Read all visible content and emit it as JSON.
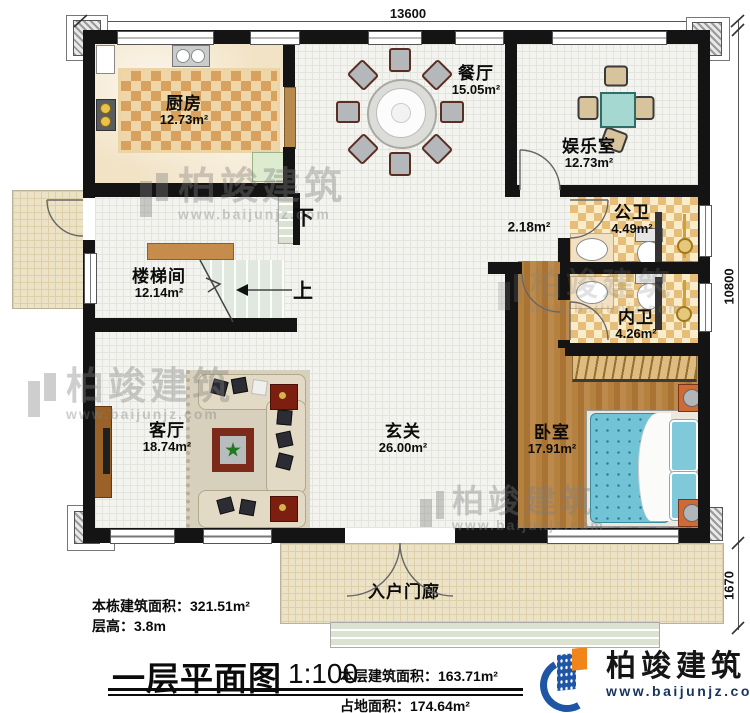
{
  "plan": {
    "dimensions": {
      "top": "13600",
      "right": "10800",
      "porch": "1670"
    },
    "rooms": [
      {
        "name": "厨房",
        "area": "12.73m²"
      },
      {
        "name": "餐厅",
        "area": "15.05m²"
      },
      {
        "name": "娱乐室",
        "area": "12.73m²"
      },
      {
        "name": "公卫",
        "area": "4.49m²"
      },
      {
        "name": "内卫",
        "area": "4.26m²"
      },
      {
        "name": "卧室",
        "area": "17.91m²"
      },
      {
        "name": "玄关",
        "area": "26.00m²"
      },
      {
        "name": "客厅",
        "area": "18.74m²"
      },
      {
        "name": "楼梯间",
        "area": "12.14m²"
      },
      {
        "name": "入户门廊",
        "area": ""
      }
    ],
    "annotations": {
      "passage_area": "2.18m²",
      "stairs_up": "上",
      "stairs_down": "下"
    }
  },
  "info": {
    "building_area_label": "本栋建筑面积：",
    "building_area_value": "321.51m²",
    "floor_height_label": "层高：",
    "floor_height_value": "3.8m"
  },
  "title_block": {
    "title": "一层平面图",
    "scale": "1:100",
    "floor_area_label": "本层建筑面积：",
    "floor_area_value": "163.71m²",
    "footprint_label": "占地面积：",
    "footprint_value": "174.64m²"
  },
  "brand": {
    "name": "柏竣建筑",
    "website": "www.baijunjz.com"
  },
  "watermark": {
    "name": "柏竣建筑",
    "website": "www.baijunjz.com"
  },
  "colors": {
    "wall": "#141414",
    "bath_checker": "#e6bd79",
    "kitchen_rug": "#d8a25e",
    "wood_floor": "#b5813e",
    "bed": "#72c3d6",
    "entertainment_table": "#a6d8d2",
    "brand_blue": "#1f55a5",
    "brand_orange": "#f08519"
  }
}
